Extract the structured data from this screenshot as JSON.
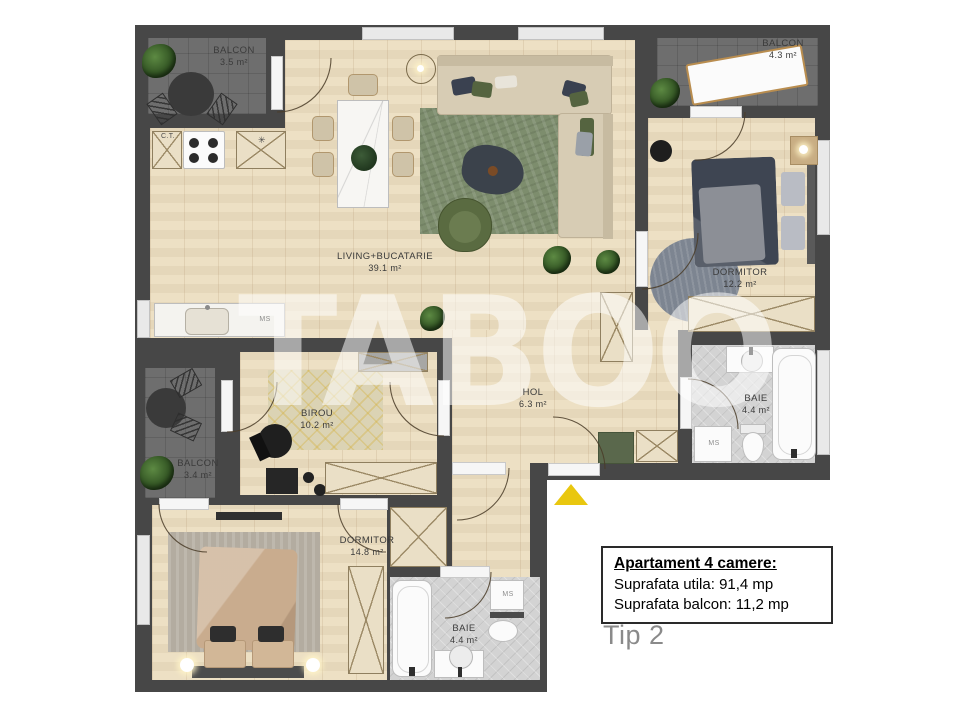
{
  "watermark": "TABOO",
  "info_box": {
    "title": "Apartament 4 camere:",
    "area_line": "Suprafata utila: 91,4 mp",
    "balcony_line": "Suprafata balcon: 11,2 mp"
  },
  "type_label": "Tip 2",
  "rooms": {
    "balcony_top_left": {
      "name": "BALCON",
      "area": "3.5 m²"
    },
    "balcony_top_right": {
      "name": "BALCON",
      "area": "4.3 m²"
    },
    "living_kitchen": {
      "name": "LIVING+BUCATARIE",
      "area": "39.1 m²"
    },
    "bedroom_right": {
      "name": "DORMITOR",
      "area": "12.2 m²"
    },
    "bathroom_right": {
      "name": "BAIE",
      "area": "4.4 m²"
    },
    "hall": {
      "name": "HOL",
      "area": "6.3 m²"
    },
    "office": {
      "name": "BIROU",
      "area": "10.2 m²"
    },
    "balcony_left": {
      "name": "BALCON",
      "area": "3.4 m²"
    },
    "bedroom_bottom": {
      "name": "DORMITOR",
      "area": "14.8 m²"
    },
    "bathroom_bottom": {
      "name": "BAIE",
      "area": "4.4 m²"
    }
  },
  "appliance_labels": {
    "central_heating": "C.T.",
    "washer": "MS",
    "star": "✳"
  },
  "colors": {
    "wall": "#474747",
    "wood_floor": "#ecdec0",
    "balcony_floor": "#6e6e6e",
    "tile_floor": "#d3d3d3",
    "rug_green": "#7d8d6d",
    "entrance_arrow": "#e9c70f"
  }
}
